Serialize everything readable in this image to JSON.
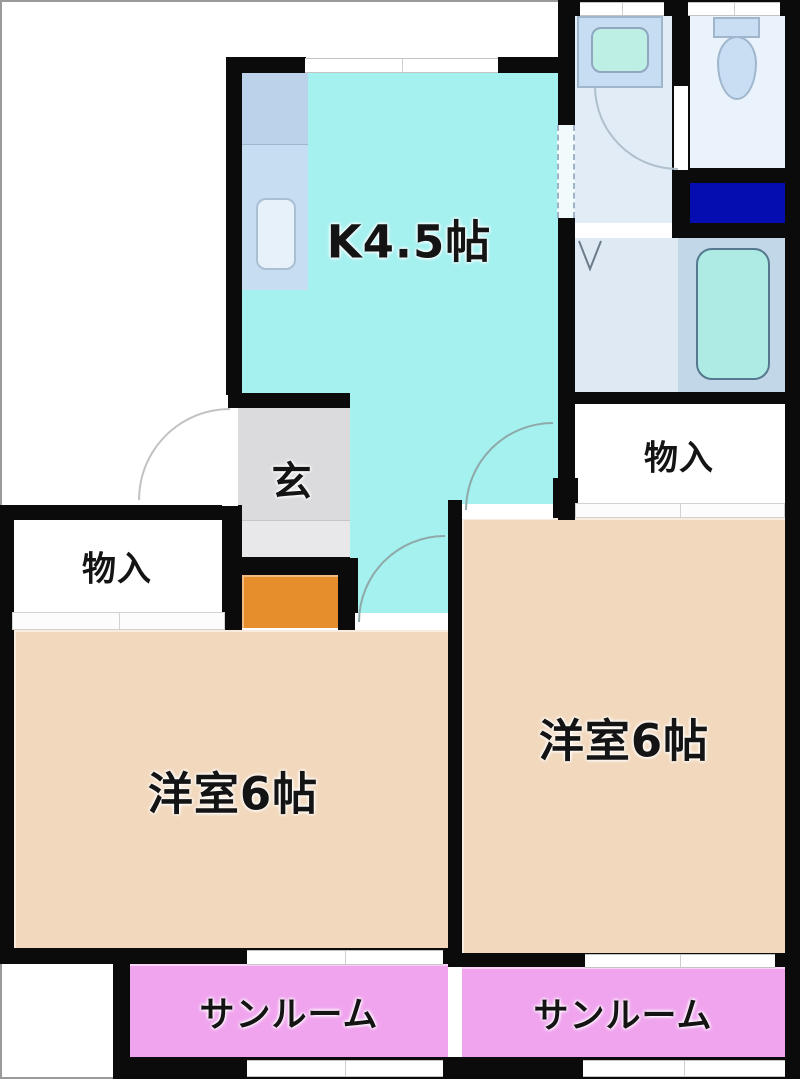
{
  "document": {
    "type": "japanese-apartment-floor-plan"
  },
  "rooms": {
    "kitchen": {
      "label": "K4.5帖"
    },
    "entrance": {
      "label": "玄"
    },
    "storage_left": {
      "label": "物入"
    },
    "storage_right": {
      "label": "物入"
    },
    "western_room_left": {
      "label": "洋室6帖"
    },
    "western_room_right": {
      "label": "洋室6帖"
    },
    "sunroom_left": {
      "label": "サンルーム"
    },
    "sunroom_right": {
      "label": "サンルーム"
    }
  },
  "fixtures": {
    "kitchen_counter": "kitchen-counter-with-sink",
    "washbasin": "washbasin-vanity",
    "toilet": "toilet",
    "bathtub": "bathtub",
    "washing_machine_space": "washing-machine-pan",
    "entrance_step": "entrance-step"
  },
  "colors": {
    "wall": "#0b0b0b",
    "kitchen": "#A4F1F0",
    "room": "#F2D8BC",
    "sunroom": "#F0A4EE",
    "entrance": "#DBDBDE",
    "entrance-low": "#E8E8EA",
    "entrance-step": "#E68E2C",
    "washer-pan": "#050CB0",
    "washroom": "#E2ECF7",
    "toilet-room": "#EAF3FB",
    "bathroom": "#DFE9F4",
    "bathtub-outer": "#C2D8E9",
    "bathtub-inner": "#AEEBE5",
    "fixture": "#C7DDF2",
    "basin": "#BEEFE5",
    "label": "#141414"
  }
}
